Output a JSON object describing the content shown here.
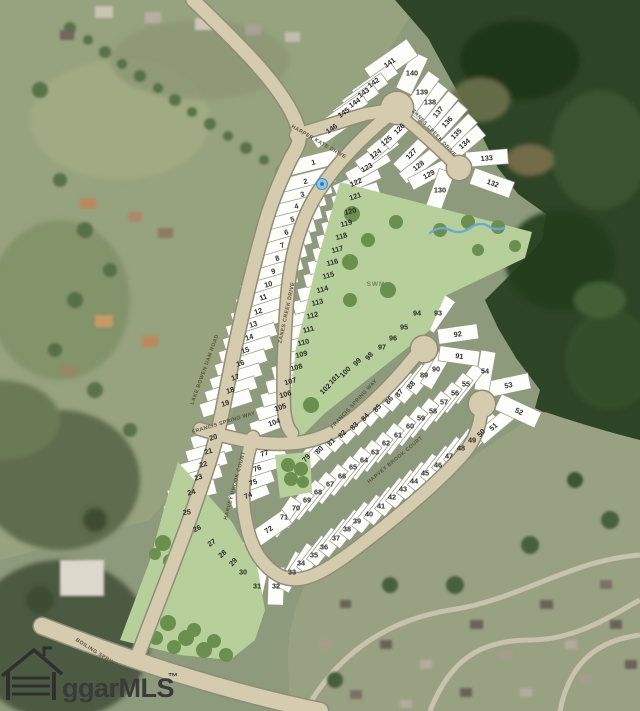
{
  "map": {
    "watermark": {
      "text": "ggarMLS",
      "tm": "™"
    },
    "swm_label": "SWM",
    "marker": {
      "type": "blue-point",
      "x": 322,
      "y": 184
    },
    "colors": {
      "road_fill": "#d5cbaf",
      "road_edge": "#8f8d77",
      "lot_fill": "#fdfdfa",
      "lot_stroke": "#97968c",
      "green_area": "#b7d09b",
      "tree": "#6a8f4e",
      "forest": "#2e4426",
      "creek": "#6fa8cf"
    },
    "streets": [
      {
        "slug": "harper-kate-drive",
        "name": "HARPER KATE DRIVE",
        "x": 318,
        "y": 143,
        "rot": 30
      },
      {
        "slug": "zanes-creek-drive-1",
        "name": "ZANES CREEK DRIVE",
        "x": 433,
        "y": 134,
        "rot": 47
      },
      {
        "slug": "zanes-creek-drive-2",
        "name": "ZANES CREEK DRIVE",
        "x": 288,
        "y": 313,
        "rot": -78
      },
      {
        "slug": "lake-bowen-dam-road",
        "name": "LAKE BOWEN DAM ROAD",
        "x": 206,
        "y": 370,
        "rot": -70
      },
      {
        "slug": "francis-spring-way-1",
        "name": "FRANCIS SPRING WAY",
        "x": 224,
        "y": 424,
        "rot": -17
      },
      {
        "slug": "francis-spring-way-2",
        "name": "FRANCIS SPRING WAY",
        "x": 355,
        "y": 405,
        "rot": -47
      },
      {
        "slug": "harvey-brook-court-1",
        "name": "HARVEY BROOK COURT",
        "x": 236,
        "y": 486,
        "rot": -75
      },
      {
        "slug": "harvey-brook-court-2",
        "name": "HARVEY BROOK COURT",
        "x": 396,
        "y": 461,
        "rot": -40
      },
      {
        "slug": "boiling-springs-road",
        "name": "BOILING SPRINGS ROAD",
        "x": 106,
        "y": 660,
        "rot": 32
      }
    ],
    "lots": [
      [
        1,
        314,
        162,
        -14,
        52,
        15
      ],
      [
        2,
        306,
        181,
        -14,
        58,
        16
      ],
      [
        3,
        303,
        194,
        -14,
        58,
        13
      ],
      [
        4,
        297,
        206,
        -14,
        58,
        13
      ],
      [
        5,
        293,
        219,
        -14,
        58,
        13
      ],
      [
        6,
        287,
        232,
        -14,
        58,
        13
      ],
      [
        7,
        283,
        245,
        -16,
        58,
        13
      ],
      [
        8,
        278,
        258,
        -16,
        58,
        13
      ],
      [
        9,
        274,
        271,
        -16,
        58,
        13
      ],
      [
        10,
        269,
        284,
        -16,
        58,
        13
      ],
      [
        11,
        264,
        297,
        -18,
        56,
        13
      ],
      [
        12,
        259,
        311,
        -18,
        56,
        13
      ],
      [
        13,
        254,
        324,
        -18,
        56,
        13
      ],
      [
        14,
        250,
        337,
        -18,
        54,
        13
      ],
      [
        15,
        246,
        350,
        -18,
        54,
        13
      ],
      [
        16,
        241,
        363,
        -18,
        52,
        13
      ],
      [
        17,
        236,
        377,
        -18,
        52,
        13
      ],
      [
        18,
        231,
        390,
        -18,
        52,
        13
      ],
      [
        19,
        226,
        403,
        -18,
        52,
        14
      ],
      [
        20,
        214,
        437,
        -18,
        46,
        14
      ],
      [
        21,
        209,
        451,
        -16,
        46,
        13
      ],
      [
        22,
        204,
        464,
        -16,
        46,
        13
      ],
      [
        23,
        199,
        477,
        -16,
        46,
        13
      ],
      [
        24,
        192,
        492,
        -14,
        48,
        15
      ],
      [
        25,
        187,
        512,
        -5,
        46,
        16
      ],
      [
        26,
        198,
        528,
        -25,
        46,
        15
      ],
      [
        27,
        213,
        542,
        -35,
        44,
        14
      ],
      [
        28,
        224,
        553,
        -42,
        42,
        13
      ],
      [
        29,
        235,
        561,
        -48,
        42,
        13
      ],
      [
        30,
        243,
        572,
        -55,
        42,
        14
      ],
      [
        31,
        257,
        586,
        -78,
        38,
        15
      ],
      [
        32,
        276,
        586,
        -88,
        38,
        16
      ],
      [
        33,
        292,
        572,
        -62,
        40,
        14
      ],
      [
        34,
        301,
        563,
        -56,
        40,
        13
      ],
      [
        35,
        314,
        555,
        -52,
        40,
        13
      ],
      [
        36,
        324,
        547,
        -52,
        40,
        13
      ],
      [
        37,
        336,
        538,
        -52,
        40,
        13
      ],
      [
        38,
        347,
        529,
        -52,
        40,
        13
      ],
      [
        39,
        357,
        521,
        -52,
        40,
        13
      ],
      [
        40,
        369,
        514,
        -52,
        40,
        13
      ],
      [
        41,
        381,
        506,
        -52,
        40,
        13
      ],
      [
        42,
        392,
        497,
        -52,
        40,
        13
      ],
      [
        43,
        403,
        489,
        -52,
        40,
        13
      ],
      [
        44,
        414,
        481,
        -52,
        40,
        13
      ],
      [
        45,
        425,
        473,
        -52,
        40,
        13
      ],
      [
        46,
        438,
        465,
        -52,
        40,
        13
      ],
      [
        47,
        449,
        456,
        -52,
        40,
        13
      ],
      [
        48,
        461,
        448,
        -52,
        40,
        13
      ],
      [
        49,
        472,
        440,
        -52,
        40,
        13
      ],
      [
        50,
        483,
        432,
        -48,
        40,
        13
      ],
      [
        51,
        495,
        426,
        -40,
        40,
        14
      ],
      [
        52,
        518,
        411,
        25,
        44,
        17
      ],
      [
        53,
        509,
        385,
        -12,
        42,
        16
      ],
      [
        54,
        485,
        371,
        -80,
        40,
        15
      ],
      [
        55,
        466,
        384,
        -52,
        42,
        13
      ],
      [
        56,
        455,
        393,
        -52,
        42,
        13
      ],
      [
        57,
        444,
        402,
        -52,
        42,
        13
      ],
      [
        58,
        433,
        411,
        -52,
        42,
        13
      ],
      [
        59,
        421,
        418,
        -52,
        42,
        13
      ],
      [
        60,
        410,
        426,
        -52,
        42,
        13
      ],
      [
        61,
        398,
        435,
        -52,
        42,
        13
      ],
      [
        62,
        386,
        443,
        -52,
        42,
        13
      ],
      [
        63,
        375,
        452,
        -52,
        42,
        13
      ],
      [
        64,
        364,
        460,
        -52,
        42,
        13
      ],
      [
        65,
        353,
        467,
        -52,
        42,
        13
      ],
      [
        66,
        342,
        476,
        -52,
        42,
        13
      ],
      [
        67,
        330,
        484,
        -52,
        42,
        13
      ],
      [
        68,
        318,
        492,
        -52,
        42,
        13
      ],
      [
        69,
        307,
        500,
        -52,
        42,
        13
      ],
      [
        70,
        296,
        508,
        -52,
        42,
        13
      ],
      [
        71,
        284,
        517,
        -55,
        42,
        13
      ],
      [
        72,
        270,
        529,
        -35,
        42,
        17
      ],
      [
        74,
        249,
        495,
        -22,
        40,
        14
      ],
      [
        75,
        254,
        482,
        -20,
        40,
        13
      ],
      [
        76,
        258,
        468,
        -18,
        40,
        13
      ],
      [
        77,
        265,
        453,
        -16,
        40,
        15
      ],
      [
        79,
        308,
        457,
        -48,
        42,
        14
      ],
      [
        80,
        321,
        449,
        -48,
        42,
        13
      ],
      [
        81,
        333,
        441,
        -48,
        42,
        13
      ],
      [
        82,
        344,
        433,
        -48,
        42,
        13
      ],
      [
        83,
        356,
        425,
        -48,
        42,
        13
      ],
      [
        84,
        367,
        416,
        -50,
        42,
        13
      ],
      [
        85,
        379,
        407,
        -50,
        42,
        13
      ],
      [
        86,
        391,
        399,
        -50,
        42,
        13
      ],
      [
        87,
        401,
        392,
        -50,
        42,
        13
      ],
      [
        88,
        413,
        384,
        -50,
        42,
        13
      ],
      [
        89,
        424,
        375,
        -52,
        42,
        13
      ],
      [
        90,
        436,
        369,
        -60,
        40,
        13
      ],
      [
        91,
        459,
        356,
        8,
        40,
        15
      ],
      [
        92,
        458,
        334,
        -8,
        40,
        15
      ],
      [
        93,
        438,
        313,
        -55,
        38,
        16
      ],
      [
        94,
        417,
        313,
        -80,
        36,
        16
      ],
      [
        95,
        404,
        327,
        -60,
        40,
        13
      ],
      [
        96,
        393,
        338,
        -55,
        40,
        13
      ],
      [
        97,
        382,
        347,
        -52,
        40,
        13
      ],
      [
        98,
        371,
        355,
        -50,
        42,
        13
      ],
      [
        99,
        359,
        361,
        -48,
        42,
        13
      ],
      [
        100,
        347,
        371,
        -46,
        44,
        13
      ],
      [
        101,
        336,
        378,
        -45,
        44,
        13
      ],
      [
        102,
        327,
        388,
        -44,
        44,
        14
      ],
      [
        104,
        275,
        422,
        -20,
        50,
        15
      ],
      [
        105,
        281,
        407,
        -18,
        50,
        13
      ],
      [
        106,
        286,
        394,
        -16,
        50,
        13
      ],
      [
        107,
        291,
        381,
        -16,
        50,
        13
      ],
      [
        108,
        297,
        367,
        -15,
        50,
        13
      ],
      [
        109,
        302,
        354,
        -15,
        50,
        13
      ],
      [
        110,
        304,
        342,
        -14,
        50,
        13
      ],
      [
        111,
        309,
        329,
        -14,
        50,
        13
      ],
      [
        112,
        313,
        315,
        -14,
        50,
        13
      ],
      [
        113,
        318,
        302,
        -14,
        50,
        13
      ],
      [
        114,
        323,
        289,
        -15,
        50,
        13
      ],
      [
        115,
        329,
        275,
        -15,
        50,
        13
      ],
      [
        116,
        333,
        262,
        -15,
        50,
        13
      ],
      [
        117,
        338,
        249,
        -15,
        50,
        13
      ],
      [
        118,
        342,
        236,
        -15,
        50,
        13
      ],
      [
        119,
        347,
        223,
        -15,
        50,
        13
      ],
      [
        120,
        351,
        211,
        -15,
        50,
        13
      ],
      [
        121,
        356,
        196,
        -18,
        48,
        14
      ],
      [
        122,
        357,
        182,
        -24,
        48,
        13
      ],
      [
        123,
        368,
        167,
        -30,
        46,
        13
      ],
      [
        124,
        377,
        153,
        -36,
        46,
        13
      ],
      [
        125,
        388,
        140,
        -40,
        46,
        13
      ],
      [
        126,
        401,
        128,
        -45,
        46,
        14
      ],
      [
        127,
        413,
        153,
        -45,
        44,
        13
      ],
      [
        128,
        420,
        165,
        -38,
        44,
        13
      ],
      [
        129,
        430,
        174,
        -28,
        44,
        13
      ],
      [
        130,
        440,
        190,
        -70,
        40,
        16
      ],
      [
        132,
        492,
        183,
        20,
        42,
        17
      ],
      [
        133,
        487,
        158,
        -5,
        42,
        15
      ],
      [
        134,
        466,
        143,
        -40,
        40,
        14
      ],
      [
        135,
        458,
        133,
        -45,
        42,
        13
      ],
      [
        136,
        449,
        121,
        -48,
        42,
        13
      ],
      [
        137,
        440,
        111,
        -50,
        42,
        13
      ],
      [
        138,
        430,
        102,
        -52,
        42,
        13
      ],
      [
        139,
        422,
        92,
        -55,
        42,
        14
      ],
      [
        140,
        412,
        73,
        -65,
        40,
        17
      ],
      [
        141,
        391,
        62,
        -35,
        52,
        20
      ],
      [
        142,
        375,
        82,
        -35,
        48,
        13
      ],
      [
        143,
        365,
        92,
        -35,
        48,
        13
      ],
      [
        144,
        356,
        102,
        -35,
        48,
        13
      ],
      [
        145,
        345,
        112,
        -35,
        48,
        13
      ],
      [
        146,
        333,
        128,
        -35,
        48,
        16
      ]
    ]
  }
}
